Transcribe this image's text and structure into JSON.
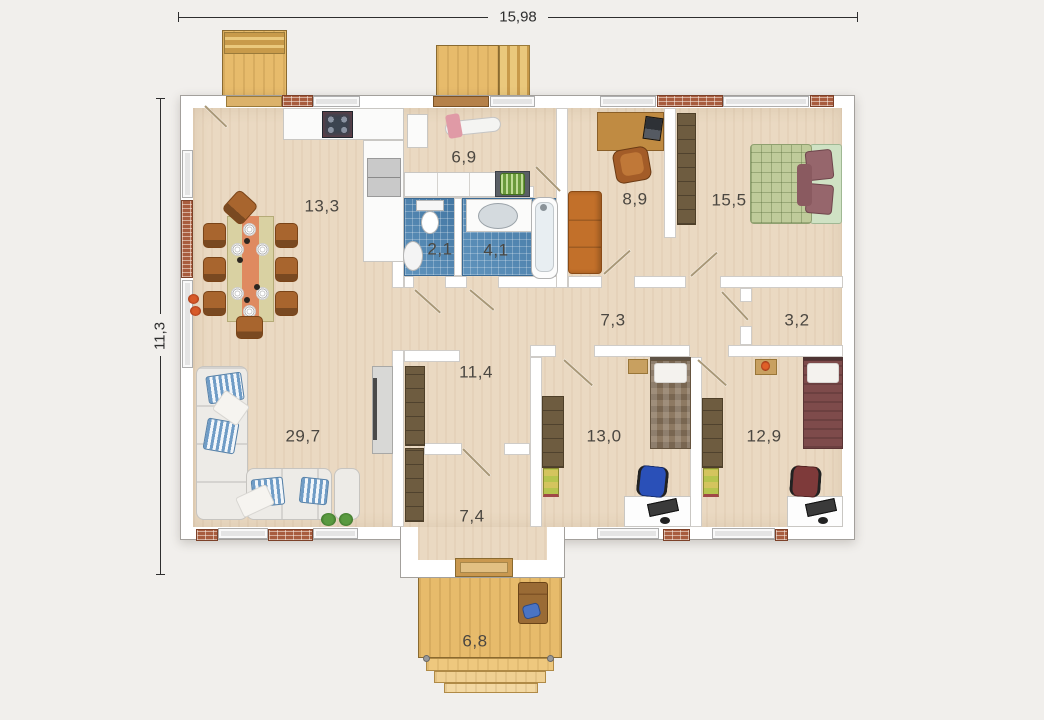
{
  "plan": {
    "type": "single-storey house floor plan, top view",
    "dimensions": {
      "width": "15,98",
      "height": "11,3"
    },
    "rooms": {
      "dining_kitchen": {
        "area": "13,3"
      },
      "utility": {
        "area": "6,9"
      },
      "wc": {
        "area": "2,1"
      },
      "bathroom": {
        "area": "4,1"
      },
      "office": {
        "area": "8,9"
      },
      "master_bedroom": {
        "area": "15,5"
      },
      "hallway": {
        "area": "7,3"
      },
      "closet": {
        "area": "3,2"
      },
      "hall": {
        "area": "11,4"
      },
      "bedroom_one": {
        "area": "13,0"
      },
      "bedroom_two": {
        "area": "12,9"
      },
      "living_room": {
        "area": "29,7"
      },
      "entry": {
        "area": "7,4"
      },
      "porch": {
        "area": "6,8"
      }
    },
    "colors": {
      "background": "#f1efec",
      "floor": "#ead9c2",
      "bath_tile": "#4d87b5",
      "deck_wood": "#e7bb6b",
      "wall": "#ffffff",
      "brick": "#a85c3e",
      "sofa_orange": "#c2702a",
      "bed_green": "#bfcb9a",
      "bed_maroon": "#7e4b4b"
    }
  }
}
